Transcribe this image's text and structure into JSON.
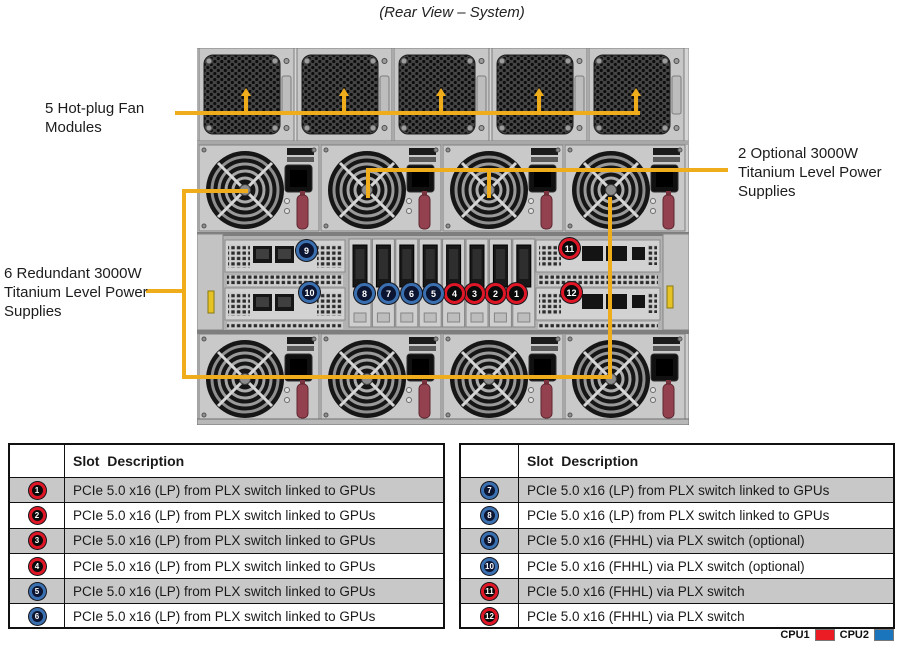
{
  "title": "(Rear View – System)",
  "callouts": {
    "fans": "5 Hot-plug Fan\nModules",
    "optional_psu": "2 Optional 3000W\nTitanium Level Power\nSupplies",
    "redundant_psu": "6 Redundant 3000W\nTitanium Level Power\nSupplies"
  },
  "diagram": {
    "slot_labels": [
      "1",
      "2",
      "3",
      "4",
      "5",
      "6",
      "7",
      "8",
      "9",
      "10",
      "11",
      "12"
    ],
    "slot_cpu": [
      "CPU1",
      "CPU1",
      "CPU1",
      "CPU1",
      "CPU2",
      "CPU2",
      "CPU2",
      "CPU2",
      "CPU2",
      "CPU2",
      "CPU1",
      "CPU1"
    ]
  },
  "tables": {
    "left": {
      "header": "Slot  Description",
      "rows": [
        {
          "slot": "1",
          "cpu": "CPU1",
          "desc": "PCIe 5.0 x16 (LP) from PLX switch linked to GPUs"
        },
        {
          "slot": "2",
          "cpu": "CPU1",
          "desc": "PCIe 5.0 x16 (LP) from PLX switch linked to GPUs"
        },
        {
          "slot": "3",
          "cpu": "CPU1",
          "desc": "PCIe 5.0 x16 (LP) from PLX switch linked to GPUs"
        },
        {
          "slot": "4",
          "cpu": "CPU1",
          "desc": "PCIe 5.0 x16 (LP) from PLX switch linked to GPUs"
        },
        {
          "slot": "5",
          "cpu": "CPU2",
          "desc": "PCIe 5.0 x16 (LP) from PLX switch linked to GPUs"
        },
        {
          "slot": "6",
          "cpu": "CPU2",
          "desc": "PCIe 5.0 x16 (LP) from PLX switch linked to GPUs"
        }
      ]
    },
    "right": {
      "header": "Slot  Description",
      "rows": [
        {
          "slot": "7",
          "cpu": "CPU2",
          "desc": "PCIe 5.0 x16 (LP) from PLX switch linked to GPUs"
        },
        {
          "slot": "8",
          "cpu": "CPU2",
          "desc": "PCIe 5.0 x16 (LP) from PLX switch linked to GPUs"
        },
        {
          "slot": "9",
          "cpu": "CPU2",
          "desc": "PCIe 5.0 x16 (FHHL) via PLX switch (optional)"
        },
        {
          "slot": "10",
          "cpu": "CPU2",
          "desc": "PCIe 5.0 x16 (FHHL) via PLX switch (optional)"
        },
        {
          "slot": "11",
          "cpu": "CPU1",
          "desc": "PCIe 5.0 x16 (FHHL) via PLX switch"
        },
        {
          "slot": "12",
          "cpu": "CPU1",
          "desc": "PCIe 5.0 x16 (FHHL) via PLX switch"
        }
      ]
    }
  },
  "legend": {
    "cpu1_label": "CPU1",
    "cpu2_label": "CPU2"
  },
  "colors": {
    "cpu1_red": "#EC1C24",
    "cpu2_blue": "#1B75BC",
    "callout_yellow": "#F0AD1B"
  }
}
